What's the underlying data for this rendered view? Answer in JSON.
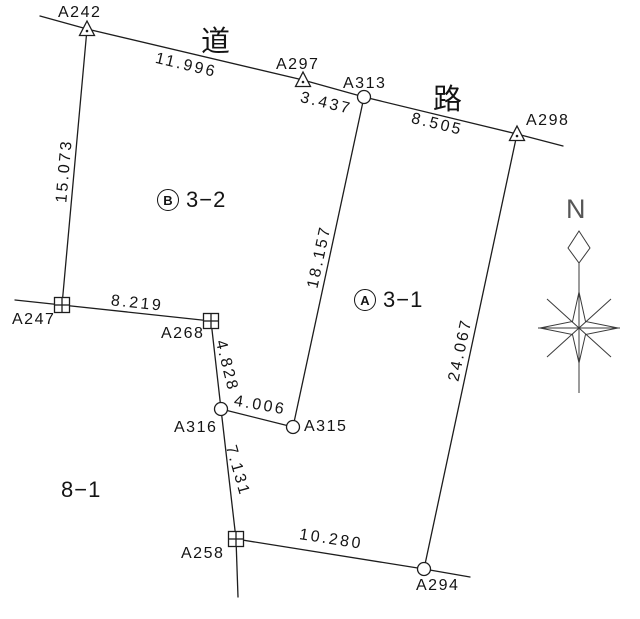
{
  "diagram": {
    "kind": "cadastral-survey-plat",
    "road_labels": [
      "道",
      "路"
    ],
    "compass": {
      "north": "N"
    },
    "parcels": [
      {
        "letter": "B",
        "number": "3−2"
      },
      {
        "letter": "A",
        "number": "3−1"
      },
      {
        "number": "8−1"
      }
    ],
    "points": [
      {
        "name": "A242",
        "marker": "triangle"
      },
      {
        "name": "A297",
        "marker": "triangle"
      },
      {
        "name": "A313",
        "marker": "circle"
      },
      {
        "name": "A298",
        "marker": "triangle"
      },
      {
        "name": "A247",
        "marker": "square"
      },
      {
        "name": "A268",
        "marker": "square"
      },
      {
        "name": "A316",
        "marker": "circle"
      },
      {
        "name": "A315",
        "marker": "circle"
      },
      {
        "name": "A258",
        "marker": "square"
      },
      {
        "name": "A294",
        "marker": "circle"
      }
    ],
    "measurements": [
      {
        "from": "A242",
        "to": "A297",
        "value": "11.996"
      },
      {
        "from": "A297",
        "to": "A313",
        "value": "3.437"
      },
      {
        "from": "A313",
        "to": "A298",
        "value": "8.505"
      },
      {
        "from": "A242",
        "to": "A247",
        "value": "15.073"
      },
      {
        "from": "A313",
        "to": "A315",
        "value": "18.157"
      },
      {
        "from": "A298",
        "to": "A294",
        "value": "24.067"
      },
      {
        "from": "A247",
        "to": "A268",
        "value": "8.219"
      },
      {
        "from": "A268",
        "to": "A316",
        "value": "4.828"
      },
      {
        "from": "A316",
        "to": "A315",
        "value": "4.006"
      },
      {
        "from": "A316",
        "to": "A258",
        "value": "7.131"
      },
      {
        "from": "A258",
        "to": "A294",
        "value": "10.280"
      }
    ]
  }
}
